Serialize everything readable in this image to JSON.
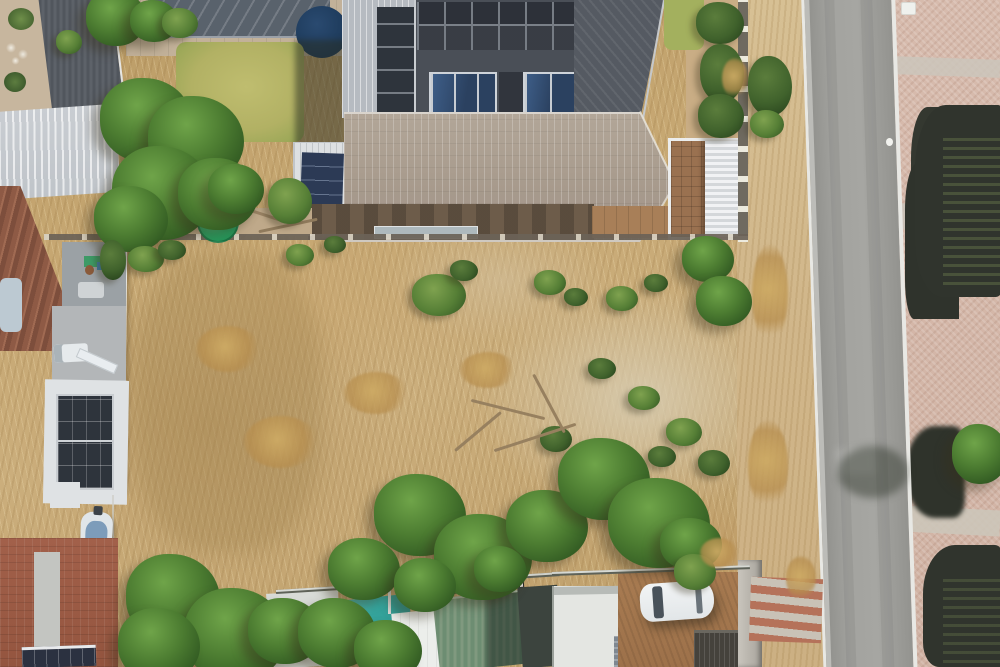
{
  "meta": {
    "type": "aerial-drone-photograph",
    "subject": "vacant residential plot of dry grass and scrub between suburban houses, bordered by a street on the right",
    "view": "top-down",
    "text_content": "none — the image contains no visible text, labels or UI elements"
  },
  "palette": {
    "grass_dry": "#c6a772",
    "grass_dry_light": "#d6bd8f",
    "grass_dry_dark": "#a8895b",
    "sand_pale": "#d5c8af",
    "bush_green": "#567f36",
    "bush_green_dark": "#2d4a20",
    "tree_green": "#4c7c31",
    "tree_green_light": "#6fa449",
    "road_gray": "#a6a6a2",
    "curb_white": "#e8e8e4",
    "verge_sand": "#d7c094",
    "paving_pink": "#d7bbad",
    "shadow_dark": "#30342d",
    "roof_tile_light": "#a79a8c",
    "roof_dark_gray": "#4a4f57",
    "solar_dark": "#2e343c",
    "solar_blue": "#2b4160",
    "roof_light_corrugated": "#c9cdd2",
    "roof_brown_tile": "#8e5a45",
    "pool_cover": "#59626c",
    "navy_circle": "#1c3959",
    "lawn_green": "#b2b164",
    "tank_green": "#2aa565",
    "pergola_white": "#eceded",
    "pergola_paving": "#9a7150",
    "pool_teal": "#35a49c",
    "roof_green": "#80997f",
    "brick_paving": "#a2604a",
    "dirt_brown": "#a87b51",
    "wall_white": "#eef0ee",
    "car_white": "#e2e6e8"
  },
  "objects": [
    "vacant-lot-dry-grass",
    "boundary-fence",
    "white-boundary-wall",
    "house-with-solar-panels-top",
    "blue-solar-panel-row",
    "tiled-roof",
    "white-pergola",
    "covered-swimming-pool",
    "trampoline-navy-circle",
    "yellow-lawn",
    "green-water-tank",
    "neighbour-house-solar-array",
    "boat-on-trailer",
    "brick-courtyard",
    "teal-pool-bottom",
    "green-corrugated-roof",
    "white-parked-car",
    "asphalt-street",
    "pink-paved-driveways",
    "tree-shadows",
    "scattered-bushes-and-trees"
  ],
  "vegetation": [
    {
      "x": 86,
      "y": -10,
      "w": 60,
      "h": 56,
      "kind": "tree"
    },
    {
      "x": 130,
      "y": 0,
      "w": 48,
      "h": 42,
      "kind": "tree"
    },
    {
      "x": 162,
      "y": 8,
      "w": 36,
      "h": 30,
      "kind": "bush"
    },
    {
      "x": 56,
      "y": 30,
      "w": 26,
      "h": 24,
      "kind": "bush"
    },
    {
      "x": 100,
      "y": 78,
      "w": 92,
      "h": 84,
      "kind": "tree"
    },
    {
      "x": 148,
      "y": 96,
      "w": 96,
      "h": 88,
      "kind": "tree"
    },
    {
      "x": 112,
      "y": 146,
      "w": 100,
      "h": 94,
      "kind": "tree"
    },
    {
      "x": 178,
      "y": 158,
      "w": 80,
      "h": 72,
      "kind": "tree"
    },
    {
      "x": 94,
      "y": 186,
      "w": 74,
      "h": 66,
      "kind": "tree"
    },
    {
      "x": 208,
      "y": 164,
      "w": 56,
      "h": 50,
      "kind": "tree"
    },
    {
      "x": 268,
      "y": 178,
      "w": 44,
      "h": 46,
      "kind": "bush"
    },
    {
      "x": 696,
      "y": 2,
      "w": 48,
      "h": 42,
      "kind": "bushd"
    },
    {
      "x": 700,
      "y": 44,
      "w": 44,
      "h": 58,
      "kind": "bushd"
    },
    {
      "x": 698,
      "y": 94,
      "w": 46,
      "h": 44,
      "kind": "bushd"
    },
    {
      "x": 722,
      "y": 58,
      "w": 26,
      "h": 40,
      "kind": "shrub"
    },
    {
      "x": 748,
      "y": 56,
      "w": 44,
      "h": 60,
      "kind": "bushd"
    },
    {
      "x": 750,
      "y": 110,
      "w": 34,
      "h": 28,
      "kind": "bush"
    },
    {
      "x": 752,
      "y": 244,
      "w": 36,
      "h": 100,
      "kind": "shrub"
    },
    {
      "x": 748,
      "y": 420,
      "w": 40,
      "h": 90,
      "kind": "shrub"
    },
    {
      "x": 786,
      "y": 556,
      "w": 30,
      "h": 44,
      "kind": "shrub"
    },
    {
      "x": 128,
      "y": 246,
      "w": 36,
      "h": 26,
      "kind": "bush"
    },
    {
      "x": 158,
      "y": 240,
      "w": 28,
      "h": 20,
      "kind": "bushd"
    },
    {
      "x": 100,
      "y": 240,
      "w": 26,
      "h": 40,
      "kind": "bushd"
    },
    {
      "x": 286,
      "y": 244,
      "w": 28,
      "h": 22,
      "kind": "bush"
    },
    {
      "x": 324,
      "y": 236,
      "w": 22,
      "h": 17,
      "kind": "bushd"
    },
    {
      "x": 412,
      "y": 274,
      "w": 54,
      "h": 42,
      "kind": "bush"
    },
    {
      "x": 450,
      "y": 260,
      "w": 28,
      "h": 21,
      "kind": "bushd"
    },
    {
      "x": 534,
      "y": 270,
      "w": 32,
      "h": 25,
      "kind": "bush"
    },
    {
      "x": 564,
      "y": 288,
      "w": 24,
      "h": 18,
      "kind": "bushd"
    },
    {
      "x": 606,
      "y": 286,
      "w": 32,
      "h": 25,
      "kind": "bush"
    },
    {
      "x": 644,
      "y": 274,
      "w": 24,
      "h": 18,
      "kind": "bushd"
    },
    {
      "x": 682,
      "y": 236,
      "w": 52,
      "h": 46,
      "kind": "tree"
    },
    {
      "x": 696,
      "y": 276,
      "w": 56,
      "h": 50,
      "kind": "tree"
    },
    {
      "x": 588,
      "y": 358,
      "w": 28,
      "h": 21,
      "kind": "bushd"
    },
    {
      "x": 628,
      "y": 386,
      "w": 32,
      "h": 24,
      "kind": "bush"
    },
    {
      "x": 666,
      "y": 418,
      "w": 36,
      "h": 28,
      "kind": "bush"
    },
    {
      "x": 698,
      "y": 450,
      "w": 32,
      "h": 26,
      "kind": "bushd"
    },
    {
      "x": 648,
      "y": 446,
      "w": 28,
      "h": 21,
      "kind": "bushd"
    },
    {
      "x": 540,
      "y": 426,
      "w": 32,
      "h": 26,
      "kind": "bushd"
    },
    {
      "x": 344,
      "y": 372,
      "w": 64,
      "h": 42,
      "kind": "shrub"
    },
    {
      "x": 244,
      "y": 416,
      "w": 74,
      "h": 52,
      "kind": "shrub"
    },
    {
      "x": 196,
      "y": 326,
      "w": 64,
      "h": 46,
      "kind": "shrub"
    },
    {
      "x": 460,
      "y": 352,
      "w": 56,
      "h": 36,
      "kind": "shrub"
    },
    {
      "x": 470,
      "y": 408,
      "w": 76,
      "h": 3,
      "kind": "branch",
      "rot": 14
    },
    {
      "x": 492,
      "y": 436,
      "w": 86,
      "h": 3,
      "kind": "branch",
      "rot": -18
    },
    {
      "x": 516,
      "y": 402,
      "w": 66,
      "h": 3,
      "kind": "branch",
      "rot": 62
    },
    {
      "x": 448,
      "y": 430,
      "w": 60,
      "h": 3,
      "kind": "branch",
      "rot": -40
    },
    {
      "x": 374,
      "y": 474,
      "w": 92,
      "h": 82,
      "kind": "tree"
    },
    {
      "x": 434,
      "y": 514,
      "w": 98,
      "h": 86,
      "kind": "tree"
    },
    {
      "x": 506,
      "y": 490,
      "w": 82,
      "h": 72,
      "kind": "tree"
    },
    {
      "x": 558,
      "y": 438,
      "w": 92,
      "h": 82,
      "kind": "tree"
    },
    {
      "x": 608,
      "y": 478,
      "w": 102,
      "h": 90,
      "kind": "tree"
    },
    {
      "x": 660,
      "y": 518,
      "w": 62,
      "h": 52,
      "kind": "tree"
    },
    {
      "x": 328,
      "y": 538,
      "w": 72,
      "h": 62,
      "kind": "tree"
    },
    {
      "x": 394,
      "y": 558,
      "w": 62,
      "h": 54,
      "kind": "tree"
    },
    {
      "x": 474,
      "y": 546,
      "w": 52,
      "h": 46,
      "kind": "tree"
    },
    {
      "x": 126,
      "y": 554,
      "w": 94,
      "h": 88,
      "kind": "tree"
    },
    {
      "x": 184,
      "y": 588,
      "w": 102,
      "h": 94,
      "kind": "tree"
    },
    {
      "x": 118,
      "y": 608,
      "w": 82,
      "h": 74,
      "kind": "tree"
    },
    {
      "x": 248,
      "y": 598,
      "w": 74,
      "h": 66,
      "kind": "tree"
    },
    {
      "x": 298,
      "y": 598,
      "w": 78,
      "h": 70,
      "kind": "tree"
    },
    {
      "x": 354,
      "y": 620,
      "w": 68,
      "h": 60,
      "kind": "tree"
    },
    {
      "x": 674,
      "y": 554,
      "w": 42,
      "h": 36,
      "kind": "bush"
    },
    {
      "x": 700,
      "y": 538,
      "w": 38,
      "h": 30,
      "kind": "shrub"
    },
    {
      "x": 952,
      "y": 424,
      "w": 56,
      "h": 60,
      "kind": "tree"
    }
  ]
}
